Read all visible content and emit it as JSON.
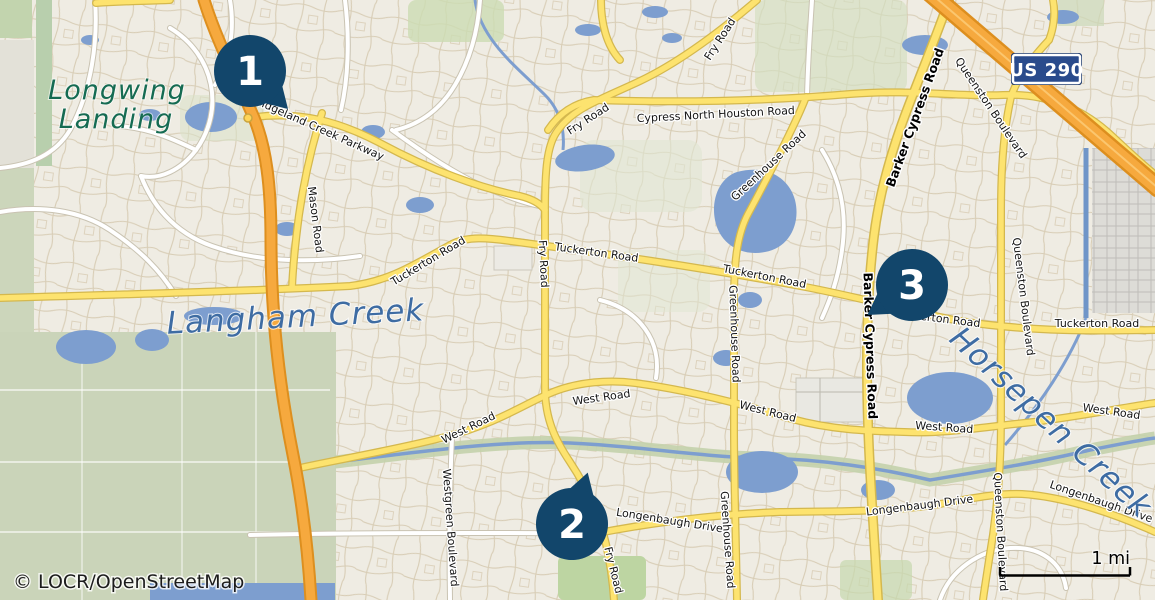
{
  "map": {
    "attribution": "© LOCR/OpenStreetMap",
    "scale": {
      "label": "1 mi"
    },
    "shield": {
      "text": "US 290"
    },
    "markers": [
      {
        "number": "1"
      },
      {
        "number": "2"
      },
      {
        "number": "3"
      }
    ],
    "place_labels": {
      "longwing_line1": "Longwing",
      "longwing_line2": "Landing",
      "langham": "Langham Creek",
      "horsepen": "Horsepen Creek"
    },
    "road_labels": [
      {
        "text": "Bridgeland Creek Parkway"
      },
      {
        "text": "Mason Road"
      },
      {
        "text": "Fry Road"
      },
      {
        "text": "Fry Road"
      },
      {
        "text": "Cypress North Houston Road"
      },
      {
        "text": "Fry Road"
      },
      {
        "text": "Tuckerton Road"
      },
      {
        "text": "Tuckerton Road"
      },
      {
        "text": "Tuckerton Road"
      },
      {
        "text": "Tuckerton Road"
      },
      {
        "text": "Tuckerton Road"
      },
      {
        "text": "Greenhouse Road"
      },
      {
        "text": "Greenhouse Road"
      },
      {
        "text": "Greenhouse Road"
      },
      {
        "text": "Barker Cypress Road"
      },
      {
        "text": "Barker Cypress Road"
      },
      {
        "text": "Queenston Boulevard"
      },
      {
        "text": "Queenston Boulevard"
      },
      {
        "text": "Queenston Boulevard"
      },
      {
        "text": "West Road"
      },
      {
        "text": "West Road"
      },
      {
        "text": "West Road"
      },
      {
        "text": "West Road"
      },
      {
        "text": "West Road"
      },
      {
        "text": "Longenbaugh Drive"
      },
      {
        "text": "Longenbaugh Drive"
      },
      {
        "text": "Longenbaugh Drive"
      },
      {
        "text": "Westgreen Boulevard"
      },
      {
        "text": "Fry Road"
      }
    ],
    "colors": {
      "marker": "#12466b",
      "water": "#7d9ecf",
      "road_yellow": "#fde36f",
      "highway_orange": "#f6a93e",
      "shield_blue": "#2a4b8c",
      "creek_label": "#3e6ca3",
      "place_label": "#156b52",
      "land": "#efece3",
      "field_green": "#cad4b9"
    }
  }
}
